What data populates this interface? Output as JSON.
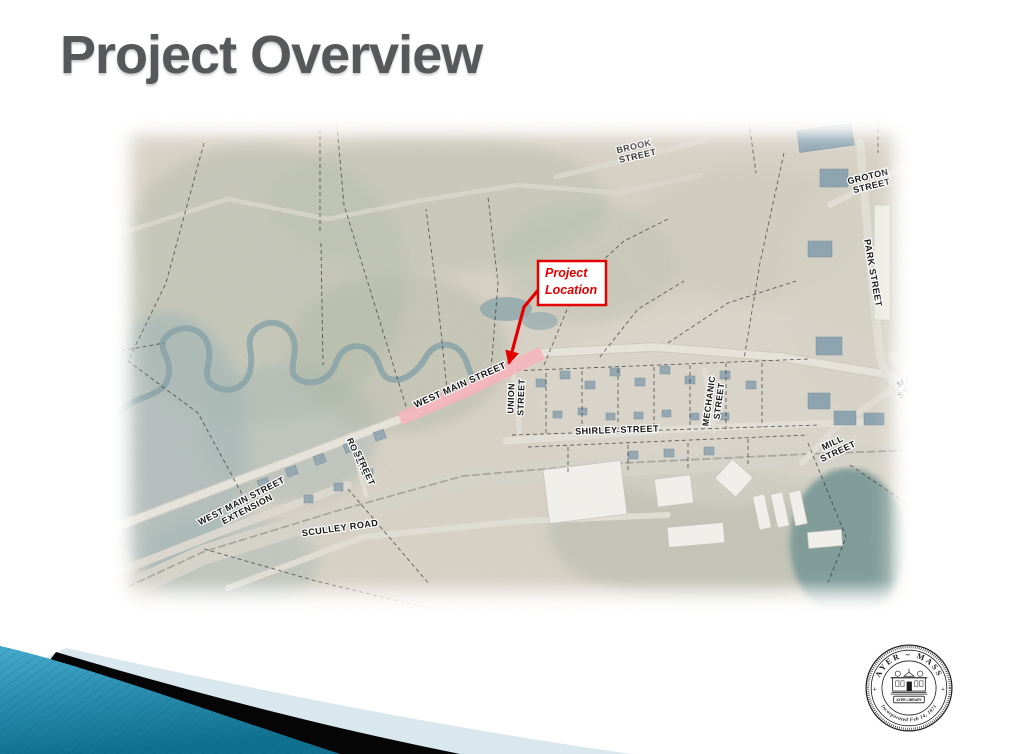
{
  "slide": {
    "title": "Project Overview"
  },
  "map": {
    "street_labels": [
      {
        "id": "brook-street",
        "lines": [
          "BROOK",
          "STREET"
        ]
      },
      {
        "id": "groton-street",
        "lines": [
          "GROTON",
          "STREET"
        ]
      },
      {
        "id": "park-street",
        "lines": [
          "PARK STREET"
        ]
      },
      {
        "id": "main-street",
        "lines": [
          "MAIN",
          "STREET"
        ]
      },
      {
        "id": "mill-street",
        "lines": [
          "MILL",
          "STREET"
        ]
      },
      {
        "id": "mechanic-street",
        "lines": [
          "MECHANIC",
          "STREET"
        ]
      },
      {
        "id": "shirley-street",
        "lines": [
          "SHIRLEY STREET"
        ]
      },
      {
        "id": "union-street",
        "lines": [
          "UNION",
          "STREET"
        ]
      },
      {
        "id": "rogers-street",
        "lines": [
          "ROGERS",
          "STREET"
        ]
      },
      {
        "id": "west-main-street",
        "lines": [
          "WEST MAIN STREET"
        ]
      },
      {
        "id": "west-main-street-extension",
        "lines": [
          "WEST MAIN STREET",
          "EXTENSION"
        ]
      },
      {
        "id": "sculley-road",
        "lines": [
          "SCULLEY ROAD"
        ]
      }
    ],
    "callout": {
      "line1": "Project",
      "line2": "Location"
    },
    "colors": {
      "highlight_pink": "#f4b4bb",
      "callout_red": "#e40000"
    }
  },
  "seal": {
    "top_text": "AYER ~ MASS",
    "banner_text": "AYER LIBRARY",
    "bottom_text": "Incorporated Feb 14, 1871",
    "left_plus": "+",
    "right_plus": "+"
  },
  "theme": {
    "title_gray": "#57585a",
    "ribbon_teal": "#2191b8",
    "ribbon_pale": "#d9e7ee",
    "ribbon_black": "#050505"
  }
}
